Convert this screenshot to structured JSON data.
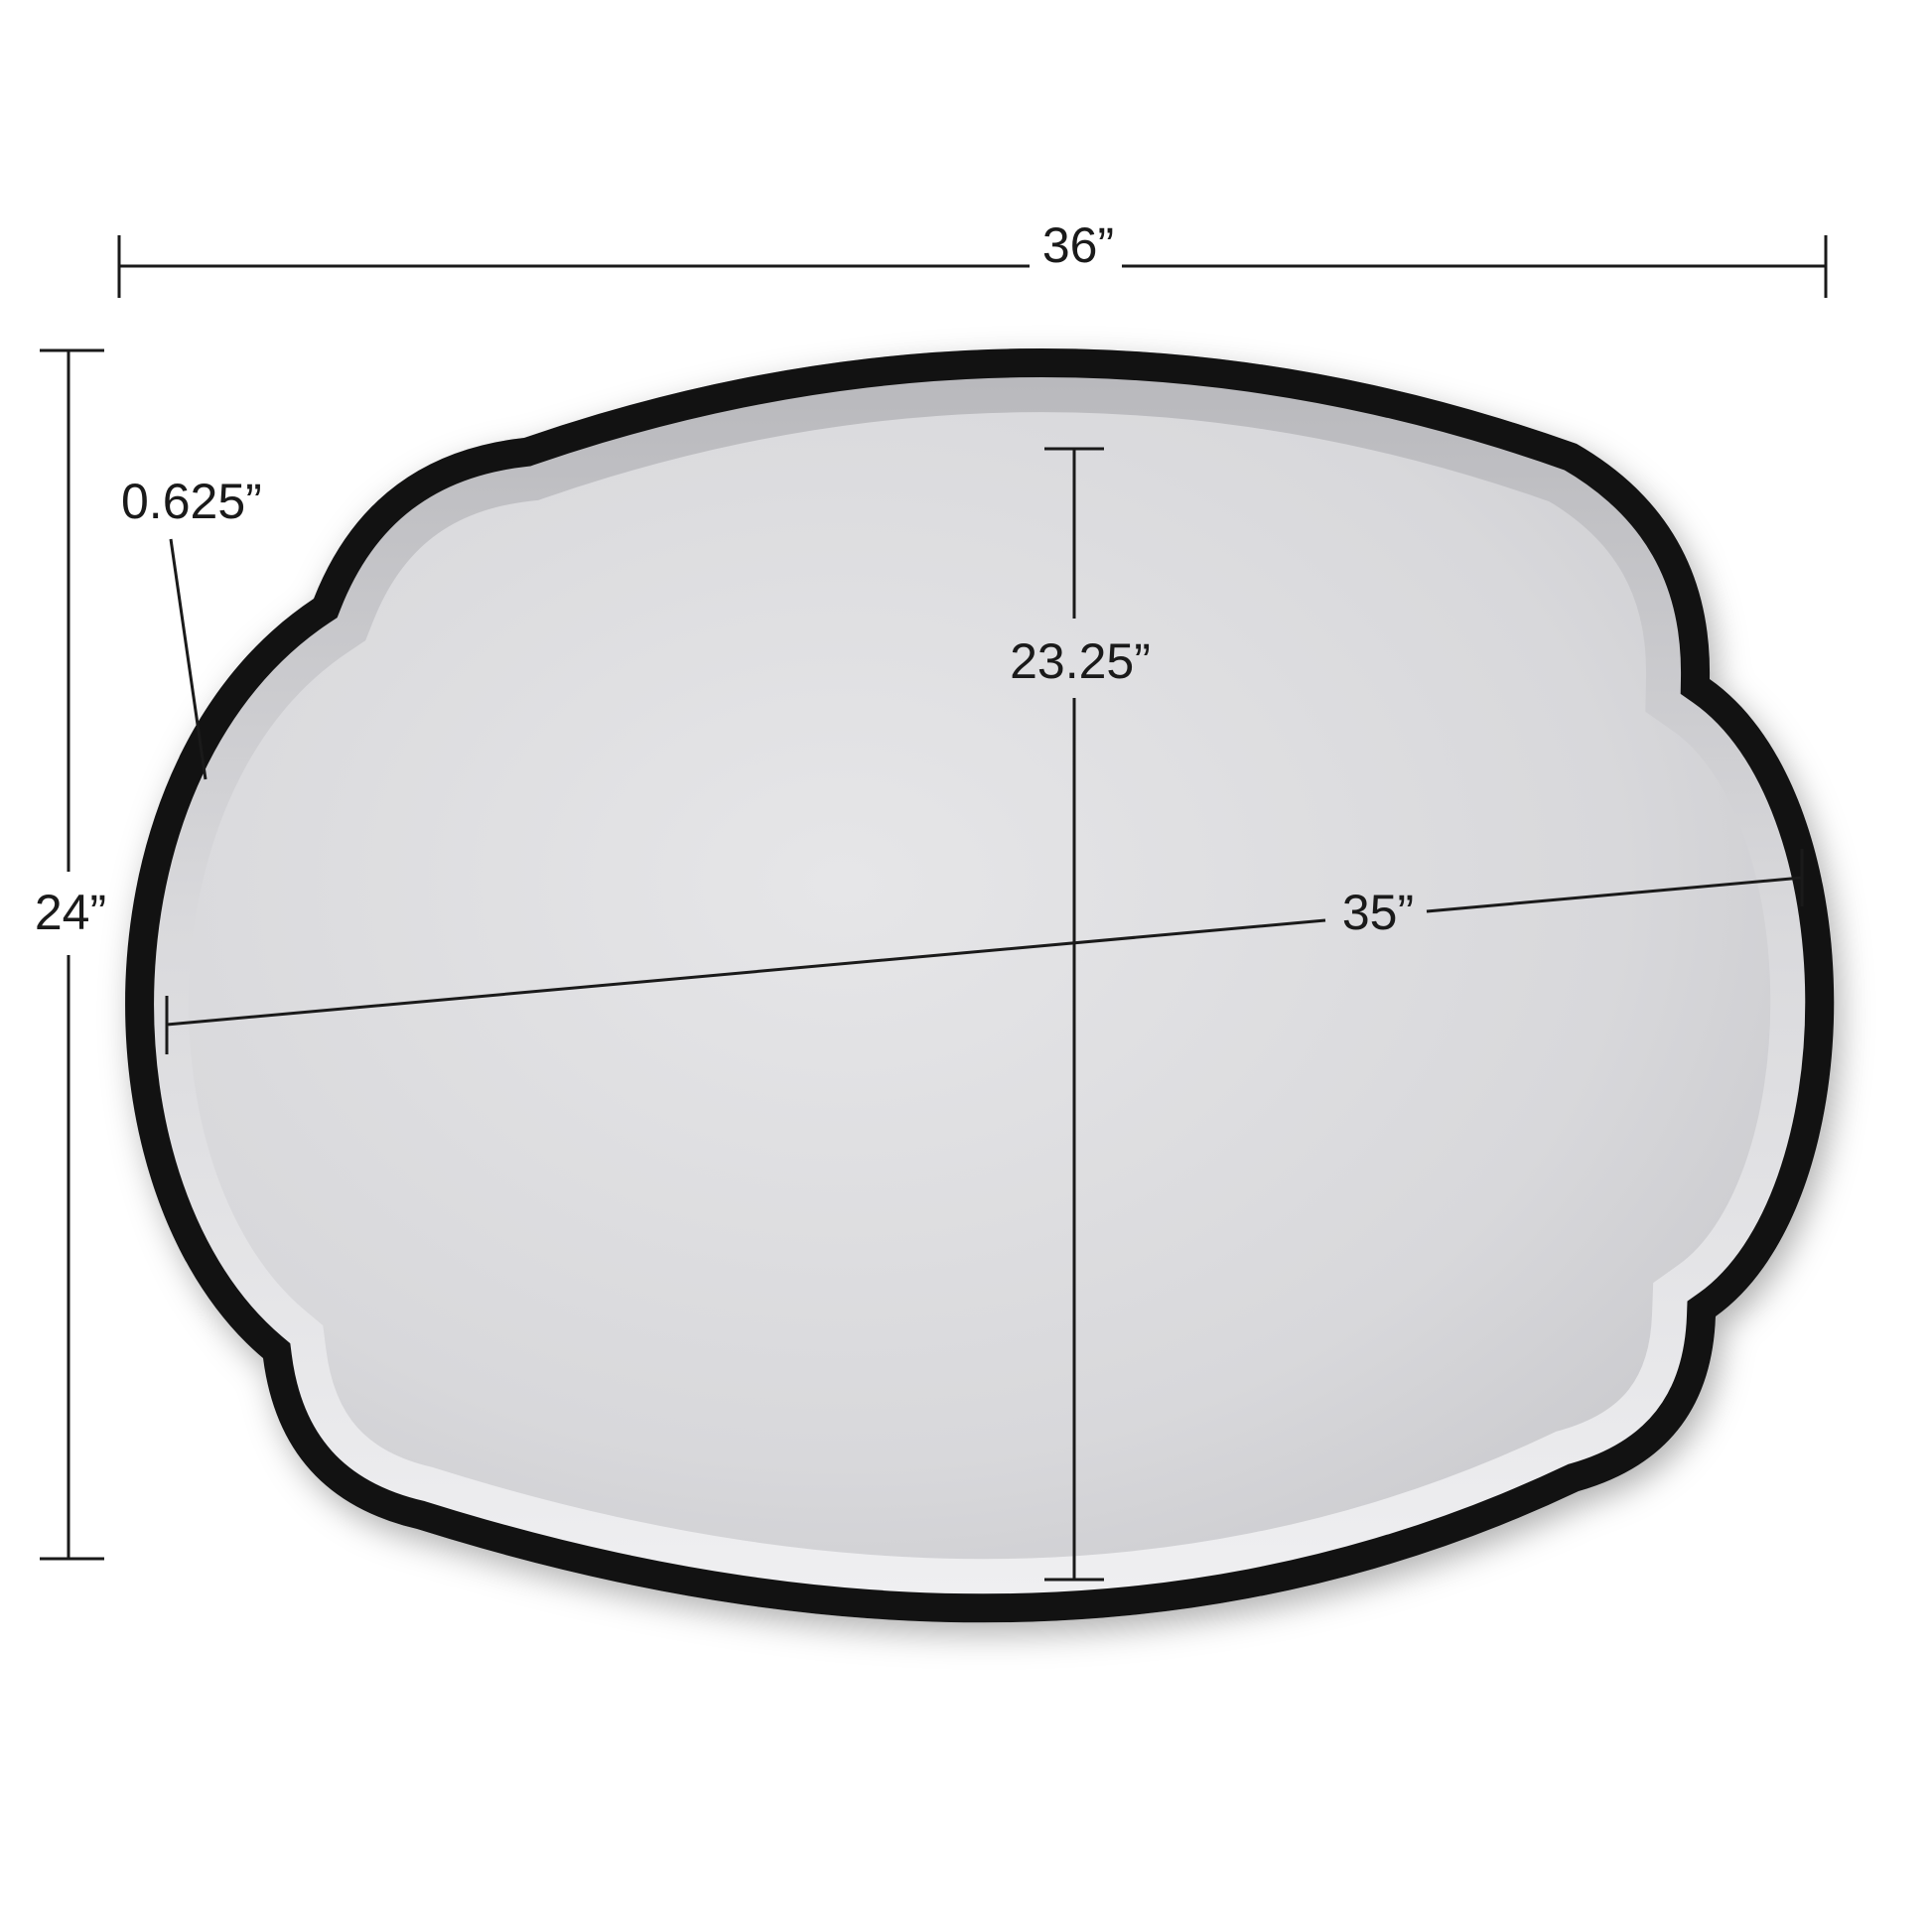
{
  "diagram": {
    "kind": "product-dimension-diagram",
    "product": "Scalloped oval wall mirror with black frame and beveled glass",
    "labels": {
      "overall_width": "36”",
      "overall_height": "24”",
      "frame_width": "0.625”",
      "glass_height": "23.25”",
      "glass_width": "35”"
    },
    "colors": {
      "background": "#ffffff",
      "frame": "#121212",
      "glass_center": "#e6e6e8",
      "glass_mid": "#d8d8db",
      "glass_edge": "#c6c6ca",
      "bevel_top": "#b7b7bb",
      "bevel_mid": "#d9d9dc",
      "bevel_bottom": "#f0f0f2",
      "dimension_lines": "#1a1a1a"
    }
  }
}
